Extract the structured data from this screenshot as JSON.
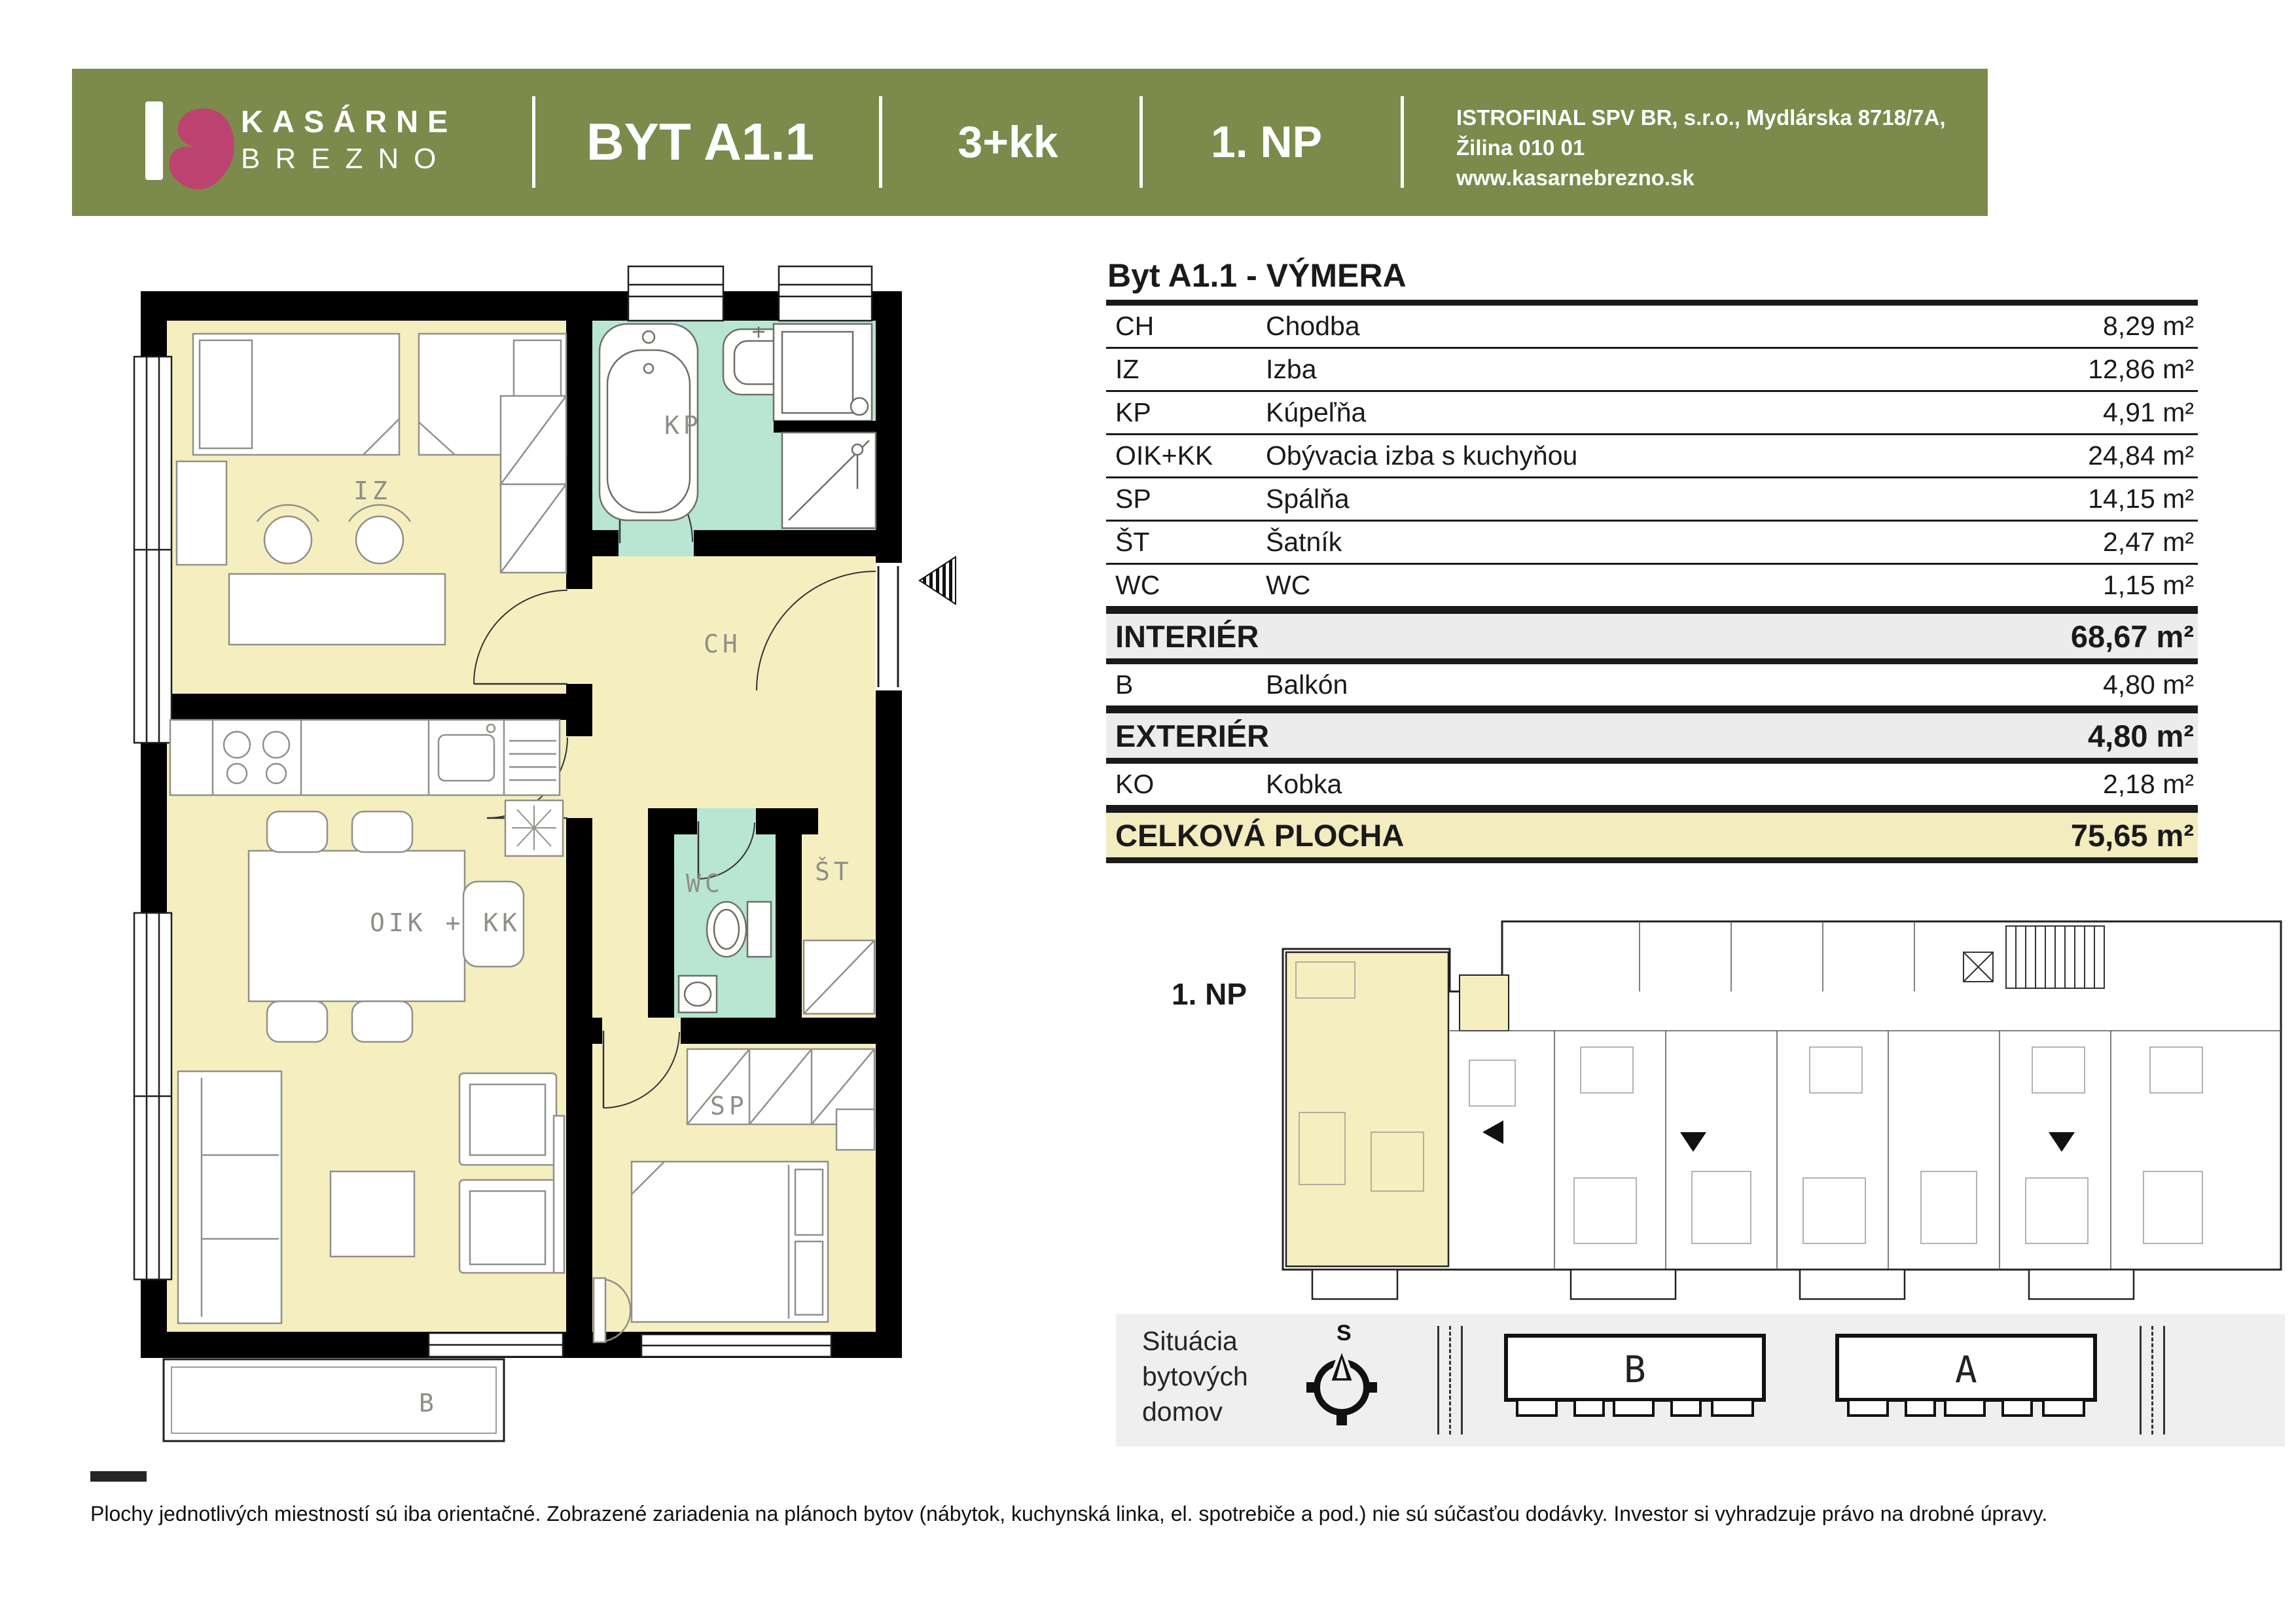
{
  "header": {
    "brand_line1": "KASÁRNE",
    "brand_line2": "BREZNO",
    "apartment": "BYT A1.1",
    "layout": "3+kk",
    "floor": "1. NP",
    "company_line1": "ISTROFINAL SPV BR, s.r.o., Mydlárska 8718/7A, Žilina 010 01",
    "company_line2": "www.kasarnebrezno.sk"
  },
  "colors": {
    "header_bar": "#7c8a4b",
    "logo_mark": "#bc4370",
    "room_fill": "#f5efc0",
    "wet_room_fill": "#b8e6d2",
    "summary_band": "#ececec",
    "total_band": "#f2ecbe"
  },
  "area_table": {
    "title": "Byt A1.1 - VÝMERA",
    "rows": [
      {
        "code": "CH",
        "name": "Chodba",
        "area": "8,29 m²"
      },
      {
        "code": "IZ",
        "name": "Izba",
        "area": "12,86 m²"
      },
      {
        "code": "KP",
        "name": "Kúpeľňa",
        "area": "4,91 m²"
      },
      {
        "code": "OIK+KK",
        "name": "Obývacia izba s kuchyňou",
        "area": "24,84 m²"
      },
      {
        "code": "SP",
        "name": "Spálňa",
        "area": "14,15 m²"
      },
      {
        "code": "ŠT",
        "name": "Šatník",
        "area": "2,47 m²"
      },
      {
        "code": "WC",
        "name": "WC",
        "area": "1,15 m²"
      }
    ],
    "interior_label": "INTERIÉR",
    "interior_area": "68,67 m²",
    "balcony_code": "B",
    "balcony_name": "Balkón",
    "balcony_area": "4,80 m²",
    "exterior_label": "EXTERIÉR",
    "exterior_area": "4,80 m²",
    "kobka_code": "KO",
    "kobka_name": "Kobka",
    "kobka_area": "2,18 m²",
    "total_label": "CELKOVÁ PLOCHA",
    "total_area": "75,65 m²"
  },
  "floor_plan": {
    "labels": {
      "iz": "IZ",
      "kp": "KP",
      "ch": "CH",
      "wc": "WC",
      "satnik": "ŠT",
      "living": "OIK + KK",
      "spalna": "SP",
      "balkon": "B"
    }
  },
  "mini_plan": {
    "floor_label": "1. NP"
  },
  "situation": {
    "line1": "Situácia",
    "line2": "bytových",
    "line3": "domov",
    "compass_label": "S",
    "building_left_label": "B",
    "building_right_label": "A"
  },
  "footer": {
    "disclaimer": "Plochy jednotlivých miestností sú iba orientačné. Zobrazené zariadenia na plánoch bytov (nábytok, kuchynská linka, el. spotrebiče a pod.) nie sú súčasťou dodávky. Investor si vyhradzuje právo na drobné úpravy."
  }
}
